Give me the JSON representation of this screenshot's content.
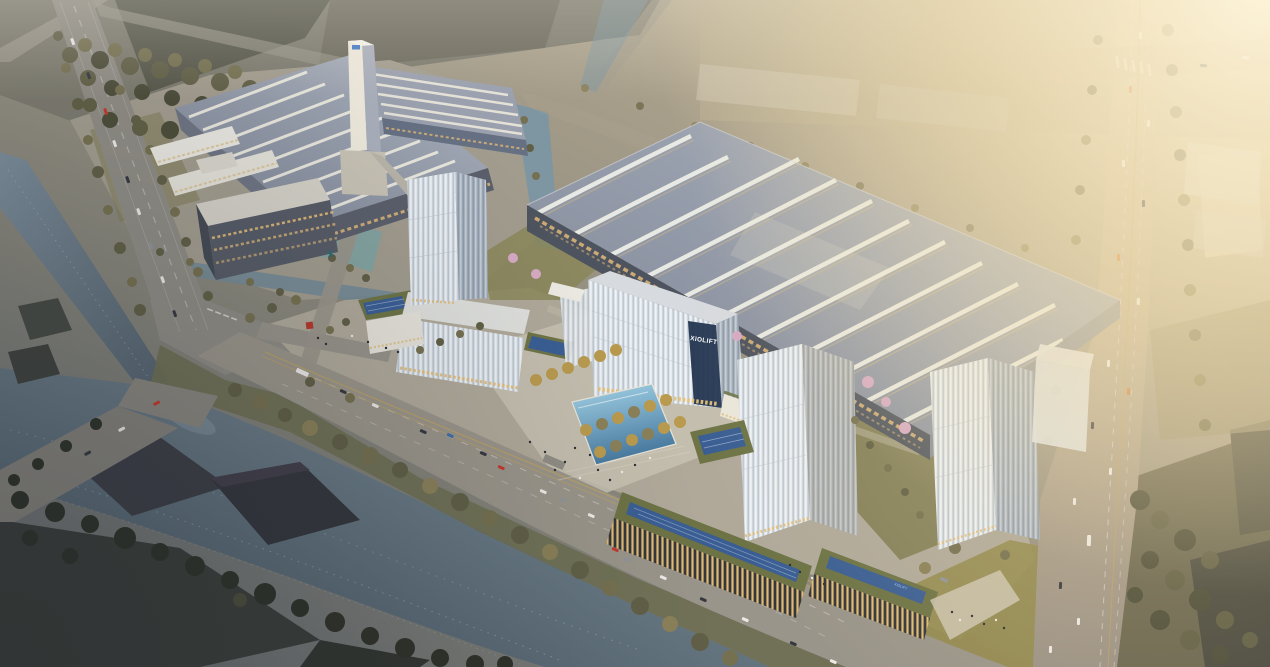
{
  "scene": {
    "description": "Aerial golden-hour architectural rendering of the XIOLIFT elevator company campus: production halls with skylight roofs, an elevator test tower, glass office towers, landscaped plaza with reflecting pool, tree-lined canal and boulevard, and a busy highway on the right.",
    "signage": {
      "headquarters_sign": "XIOLIFT",
      "podium_sign": "XIOLIFT"
    },
    "palette": {
      "golden_haze": "#f5e3b4",
      "hall_roof": "#9aa0af",
      "skylight_strip": "#edeee6",
      "glass_light": "#dde3e9",
      "glass_shadow": "#a7b2bf",
      "window_glow": "#e2bc74",
      "canal_water": "#6b7e8b",
      "pool_water": "#7fb5d4",
      "foliage": "#5f5c43",
      "autumn_tree": "#b99a4e",
      "cherry_blossom": "#d6aac4",
      "road": "#95918a",
      "solar_panel": "#3a5e94",
      "green_roof": "#6d7345",
      "accent_red": "#b5382c"
    }
  }
}
